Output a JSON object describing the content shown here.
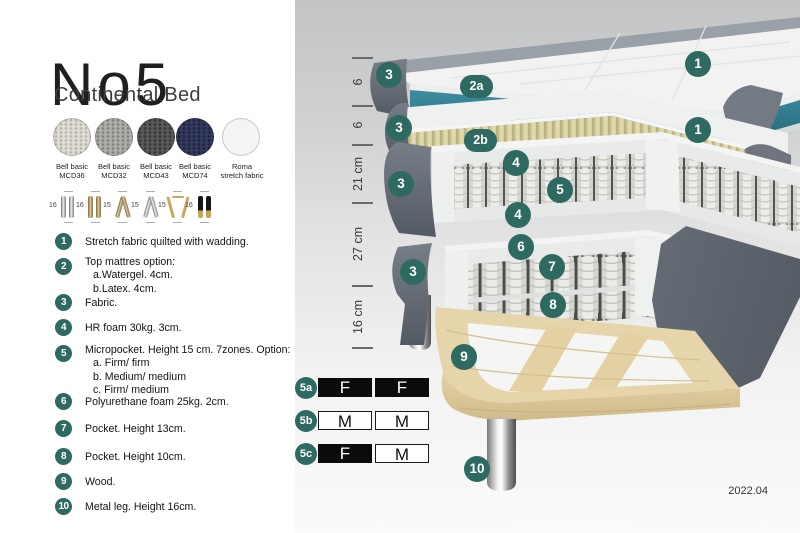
{
  "header": {
    "title": "No5",
    "subtitle": "Continental Bed"
  },
  "swatches": [
    {
      "line1": "Bell basic",
      "line2": "MCD36"
    },
    {
      "line1": "Bell basic",
      "line2": "MCD32"
    },
    {
      "line1": "Bell basic",
      "line2": "MCD43"
    },
    {
      "line1": "Bell basic",
      "line2": "MCD74"
    },
    {
      "line1": "Roma",
      "line2": "stretch fabric"
    }
  ],
  "leg_options": [
    {
      "size": "16",
      "type": "cylinder-silver"
    },
    {
      "size": "16",
      "type": "cylinder-gold"
    },
    {
      "size": "15",
      "type": "twist-gold"
    },
    {
      "size": "15",
      "type": "twist-silver"
    },
    {
      "size": "15",
      "type": "hairpin-gold"
    },
    {
      "size": "16",
      "type": "straight-black-gold"
    }
  ],
  "spec_list": [
    {
      "num": "1",
      "text": "Stretch fabric quilted with wadding."
    },
    {
      "num": "2",
      "text": "Top mattres option:",
      "sub": [
        "a.Watergel. 4cm.",
        "b.Latex. 4cm."
      ]
    },
    {
      "num": "3",
      "text": "Fabric."
    },
    {
      "num": "4",
      "text": "HR foam 30kg. 3cm."
    },
    {
      "num": "5",
      "text": "Micropocket. Height 15 cm. 7zones. Option:",
      "sub": [
        "a. Firm/ firm",
        "b. Medium/ medium",
        "c. Firm/ medium"
      ]
    },
    {
      "num": "6",
      "text": "Polyurethane foam 25kg. 2cm."
    },
    {
      "num": "7",
      "text": "Pocket. Height 13cm."
    },
    {
      "num": "8",
      "text": "Pocket. Height 10cm."
    },
    {
      "num": "9",
      "text": "Wood."
    },
    {
      "num": "10",
      "text": "Metal leg. Height 16cm."
    }
  ],
  "diagram": {
    "ruler": {
      "labels": [
        "6",
        "6",
        "21 cm",
        "27 cm",
        "16 cm"
      ]
    },
    "callouts": [
      "3",
      "2a",
      "1",
      "3",
      "2b",
      "1",
      "4",
      "5",
      "3",
      "4",
      "6",
      "7",
      "3",
      "8",
      "9",
      "10"
    ]
  },
  "firmness": {
    "rows": [
      {
        "label": "5a",
        "cells": [
          "F",
          "F"
        ]
      },
      {
        "label": "5b",
        "cells": [
          "M",
          "M"
        ]
      },
      {
        "label": "5c",
        "cells": [
          "F",
          "M"
        ]
      }
    ]
  },
  "version": "2022.04",
  "colors": {
    "accent_circle_green": "#2e6a61",
    "watergel_teal": "#2f7e92",
    "latex_tan": "#d8d1a5",
    "fabric_gray": "#6e7480",
    "wood": "#e6d4ab",
    "firmness_black": "#0b0b0b"
  }
}
